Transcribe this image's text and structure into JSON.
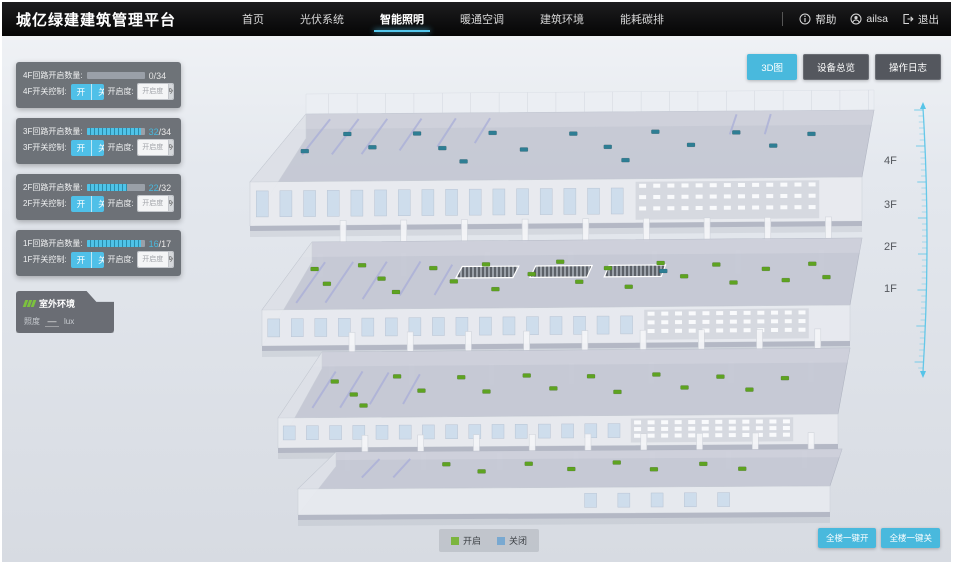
{
  "header": {
    "title": "城亿绿建建筑管理平台",
    "nav": [
      {
        "id": "home",
        "label": "首页",
        "active": false
      },
      {
        "id": "pv-system",
        "label": "光伏系统",
        "active": false
      },
      {
        "id": "smart-lighting",
        "label": "智能照明",
        "active": true
      },
      {
        "id": "hvac",
        "label": "暖通空调",
        "active": false
      },
      {
        "id": "building-env",
        "label": "建筑环境",
        "active": false
      },
      {
        "id": "energy-carbon",
        "label": "能耗碳排",
        "active": false
      }
    ],
    "help_label": "帮助",
    "user_name": "ailsa",
    "logout_label": "退出"
  },
  "view_buttons": [
    {
      "id": "view-3d",
      "label": "3D图",
      "active": true
    },
    {
      "id": "device-overview",
      "label": "设备总览",
      "active": false
    },
    {
      "id": "operation-log",
      "label": "操作日志",
      "active": false
    }
  ],
  "floor_panels": [
    {
      "floor": "4F",
      "circuit_label": "4F回路开启数量:",
      "on": 0,
      "total": 34,
      "switch_label": "4F开关控制:",
      "on_label": "开",
      "off_label": "关",
      "dim_label": "开启度:",
      "dim_placeholder": "开启度",
      "percent_label": "%"
    },
    {
      "floor": "3F",
      "circuit_label": "3F回路开启数量:",
      "on": 32,
      "total": 34,
      "switch_label": "3F开关控制:",
      "on_label": "开",
      "off_label": "关",
      "dim_label": "开启度:",
      "dim_placeholder": "开启度",
      "percent_label": "%"
    },
    {
      "floor": "2F",
      "circuit_label": "2F回路开启数量:",
      "on": 22,
      "total": 32,
      "switch_label": "2F开关控制:",
      "on_label": "开",
      "off_label": "关",
      "dim_label": "开启度:",
      "dim_placeholder": "开启度",
      "percent_label": "%"
    },
    {
      "floor": "1F",
      "circuit_label": "1F回路开启数量:",
      "on": 16,
      "total": 17,
      "switch_label": "1F开关控制:",
      "on_label": "开",
      "off_label": "关",
      "dim_label": "开启度:",
      "dim_placeholder": "开启度",
      "percent_label": "%"
    }
  ],
  "outdoor": {
    "title": "室外环境",
    "metric": "照度",
    "value": "—",
    "unit": "lux"
  },
  "floor_scale": [
    "4F",
    "3F",
    "2F",
    "1F"
  ],
  "legend": [
    {
      "id": "on",
      "label": "开启",
      "color": "#7cb53e"
    },
    {
      "id": "off",
      "label": "关闭",
      "color": "#79a9d1"
    }
  ],
  "bulk_buttons": [
    {
      "id": "all-on",
      "label": "全楼一键开"
    },
    {
      "id": "all-off",
      "label": "全楼一键关"
    }
  ],
  "colors": {
    "accent": "#49b9dd",
    "marker_on": "#5ea321",
    "marker_off": "#2e7e94"
  },
  "building": {
    "floors": [
      {
        "id": "4F",
        "marker_color": "#2e7e94",
        "markers": [
          [
            0.05,
            0.55
          ],
          [
            0.1,
            0.3
          ],
          [
            0.16,
            0.5
          ],
          [
            0.22,
            0.3
          ],
          [
            0.28,
            0.52
          ],
          [
            0.35,
            0.3
          ],
          [
            0.42,
            0.55
          ],
          [
            0.49,
            0.32
          ],
          [
            0.56,
            0.52
          ],
          [
            0.63,
            0.3
          ],
          [
            0.7,
            0.5
          ],
          [
            0.77,
            0.32
          ],
          [
            0.84,
            0.52
          ],
          [
            0.9,
            0.35
          ],
          [
            0.6,
            0.72
          ],
          [
            0.33,
            0.72
          ]
        ]
      },
      {
        "id": "3F",
        "marker_color": "#5ea321",
        "off_markers": [
          [
            0.66,
            0.47
          ]
        ],
        "markers": [
          [
            0.04,
            0.4
          ],
          [
            0.08,
            0.62
          ],
          [
            0.12,
            0.35
          ],
          [
            0.17,
            0.55
          ],
          [
            0.21,
            0.75
          ],
          [
            0.25,
            0.4
          ],
          [
            0.3,
            0.6
          ],
          [
            0.34,
            0.35
          ],
          [
            0.38,
            0.72
          ],
          [
            0.43,
            0.5
          ],
          [
            0.47,
            0.32
          ],
          [
            0.52,
            0.62
          ],
          [
            0.56,
            0.42
          ],
          [
            0.61,
            0.7
          ],
          [
            0.65,
            0.35
          ],
          [
            0.7,
            0.55
          ],
          [
            0.75,
            0.38
          ],
          [
            0.79,
            0.65
          ],
          [
            0.84,
            0.45
          ],
          [
            0.88,
            0.62
          ],
          [
            0.92,
            0.38
          ],
          [
            0.95,
            0.58
          ]
        ]
      },
      {
        "id": "2F",
        "marker_color": "#5ea321",
        "markers": [
          [
            0.06,
            0.45
          ],
          [
            0.11,
            0.65
          ],
          [
            0.17,
            0.38
          ],
          [
            0.23,
            0.6
          ],
          [
            0.29,
            0.4
          ],
          [
            0.35,
            0.62
          ],
          [
            0.41,
            0.38
          ],
          [
            0.47,
            0.58
          ],
          [
            0.53,
            0.4
          ],
          [
            0.59,
            0.64
          ],
          [
            0.65,
            0.38
          ],
          [
            0.71,
            0.58
          ],
          [
            0.77,
            0.42
          ],
          [
            0.83,
            0.62
          ],
          [
            0.89,
            0.45
          ],
          [
            0.14,
            0.82
          ]
        ]
      },
      {
        "id": "1F",
        "marker_color": "#5ea321",
        "markers": [
          [
            0.24,
            0.35
          ],
          [
            0.32,
            0.55
          ],
          [
            0.4,
            0.35
          ],
          [
            0.49,
            0.5
          ],
          [
            0.57,
            0.33
          ],
          [
            0.65,
            0.52
          ],
          [
            0.74,
            0.38
          ],
          [
            0.82,
            0.52
          ]
        ]
      }
    ]
  }
}
